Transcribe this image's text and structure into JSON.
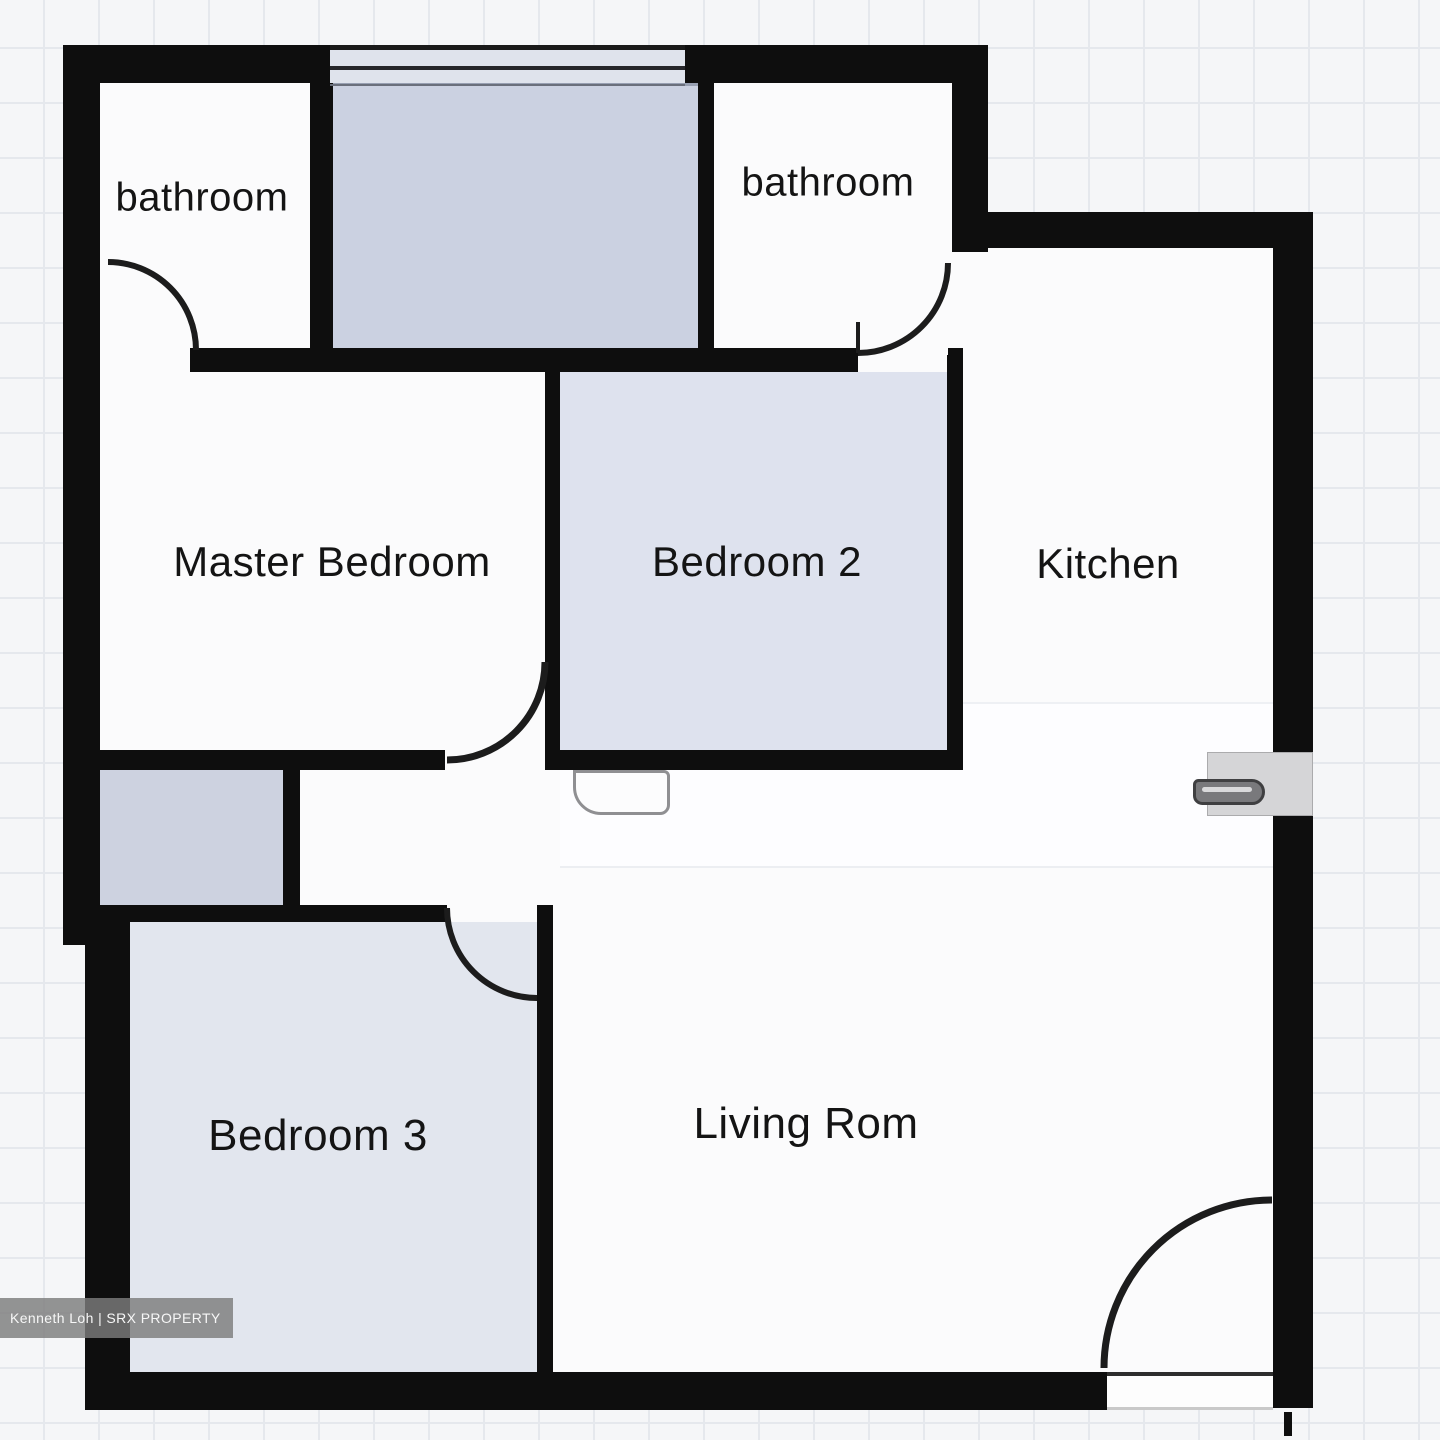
{
  "title": "3-bedroom apartment floor plan",
  "rooms": [
    {
      "id": "bathroom-1",
      "label": "bathroom"
    },
    {
      "id": "bathroom-2",
      "label": "bathroom"
    },
    {
      "id": "master-bedroom",
      "label": "Master Bedroom"
    },
    {
      "id": "bedroom-2",
      "label": "Bedroom 2"
    },
    {
      "id": "kitchen",
      "label": "Kitchen"
    },
    {
      "id": "bedroom-3",
      "label": "Bedroom 3"
    },
    {
      "id": "living-room",
      "label": "Living Rom"
    }
  ],
  "watermark": {
    "text": "Kenneth Loh | SRX PROPERTY"
  },
  "colors": {
    "wall": "#0e0e0e",
    "paper": "#f5f6f8",
    "grid_line": "#e5e8ed",
    "room_white": "#fbfbfc",
    "room_shaded_mid": "#cbd1e1",
    "room_shaded_bed2": "#dee2ee",
    "room_shaded_bed3": "#e2e6ee",
    "room_shaded_closet": "#cdd2e0",
    "window_band": "#dfe3ec",
    "arc": "#1c1c1c",
    "handle_box": "#d5d5d7",
    "label": "#141414",
    "watermark_bg": "rgba(125,125,125,0.82)",
    "watermark_text": "#f7f7f7"
  }
}
